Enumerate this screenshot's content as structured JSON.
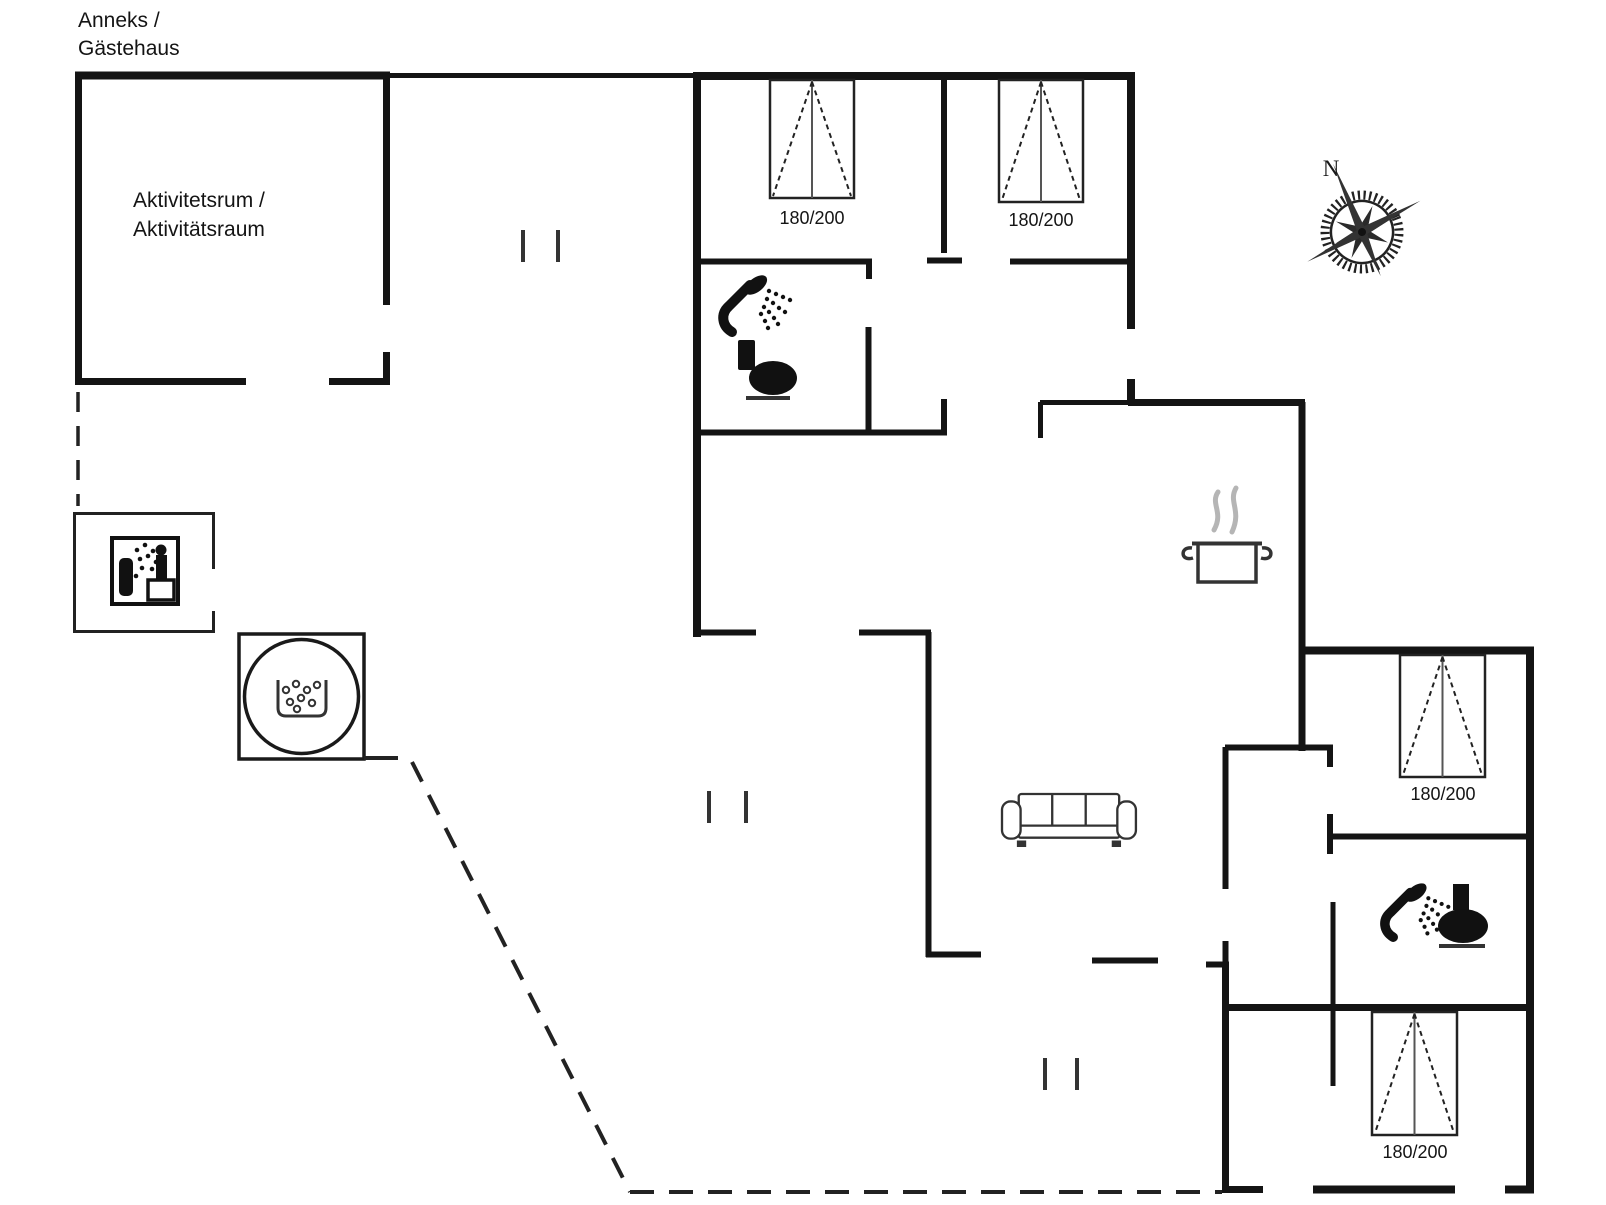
{
  "title": {
    "line1": "Anneks /",
    "line2": "Gästehaus"
  },
  "activity_room": {
    "line1": "Aktivitetsrum /",
    "line2": "Aktivitätsraum"
  },
  "compass": {
    "north": "N"
  },
  "beds": [
    {
      "label": "180/200"
    },
    {
      "label": "180/200"
    },
    {
      "label": "180/200"
    },
    {
      "label": "180/200"
    }
  ],
  "colors": {
    "wall": "#141414",
    "icon": "#111111",
    "steam": "#b5b5b5",
    "background": "#ffffff"
  }
}
